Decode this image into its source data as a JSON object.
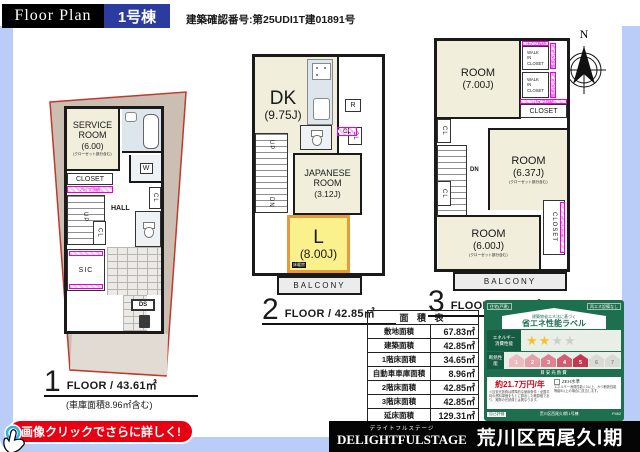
{
  "header": {
    "title": "Floor Plan",
    "unit": "1号棟",
    "permit": "建築確認番号:第25UDI1T建01891号"
  },
  "compass": {
    "north": "N"
  },
  "floor1": {
    "service_room": {
      "name": "SERVICE\nROOM",
      "size": "(6.00)",
      "note": "(クローゼット部分含む)"
    },
    "closet": "CLOSET",
    "pipe": "パイプ収納",
    "w": "W",
    "hall": "HALL",
    "up": "UP",
    "cl": "CL",
    "sic": "SIC",
    "ds": "DS",
    "label": {
      "num": "1",
      "text": "FLOOR / 43.61㎡",
      "sub": "(車庫面積8.96㎡含む)"
    }
  },
  "floor2": {
    "dk": {
      "name": "DK",
      "size": "(9.75J)"
    },
    "r": "R",
    "cl": "CL",
    "up": "UP",
    "dn": "DN",
    "japanese_room": {
      "name": "JAPANESE\nROOM",
      "size": "(3.12J)"
    },
    "living": {
      "name": "L",
      "size": "(8.00J)",
      "heating": "床暖房"
    },
    "balcony": "BALCONY",
    "label": {
      "num": "2",
      "text": "FLOOR / 42.85㎡"
    }
  },
  "floor3": {
    "room_top": {
      "name": "ROOM",
      "size": "(7.00J)"
    },
    "wic": "WALK\nIN\nCLOSET",
    "pipe": "パイプ収納",
    "closet": "CLOSET",
    "cl": "CL",
    "dn": "DN",
    "room_mid": {
      "name": "ROOM",
      "size": "(6.37J)",
      "note": "(クローゼット部分含む)"
    },
    "room_bottom": {
      "name": "ROOM",
      "size": "(6.00J)",
      "note": "(クローゼット部分含む)"
    },
    "balcony": "BALCONY",
    "label": {
      "num": "3",
      "text": "FLOOR / 42.85㎡"
    }
  },
  "area_table": {
    "title": "面 積 表",
    "rows": [
      {
        "label": "敷地面積",
        "value": "67.83㎡"
      },
      {
        "label": "建築面積",
        "value": "42.85㎡"
      },
      {
        "label": "1階床面積",
        "value": "34.65㎡"
      },
      {
        "label": "自動車車庫面積",
        "value": "8.96㎡"
      },
      {
        "label": "2階床面積",
        "value": "42.85㎡"
      },
      {
        "label": "3階床面積",
        "value": "42.85㎡"
      },
      {
        "label": "延床面積",
        "value": "129.31㎡"
      },
      {
        "label": "容積対象面積",
        "value": "120.35㎡"
      }
    ]
  },
  "energy_label": {
    "tag_left": "住宅(戸建)",
    "tag_right": "再エネ設備なし",
    "header_small": "建築物省エネ法に基づく",
    "header_main": "省エネ性能ラベル",
    "row_energy": "エネルギー\n消費性能",
    "row_insulation": "断熱性能",
    "stars_total": 4,
    "stars_filled": 2,
    "insulation_levels": 7,
    "insulation_achieved": 5,
    "cost_heading": "目安光熱費",
    "cost_value": "約21.7万円/年",
    "zeh": "ZEH水準",
    "note_left": "※目安光熱費は標準的な使用条件・全国平均の燃料単価をもとに算出した概算値であり、実際の光熱費とは異なります。",
    "note_right": "エネルギー消費性能☆3以上、かつ断熱性能等級5以上の場合に該当します。",
    "footer_left": "自己評価",
    "footer_mid": "荒川区西尾久Ⅰ期 1号棟",
    "footer_right": "P462"
  },
  "cta": {
    "text": "画像クリックでさらに詳しく!"
  },
  "footer_banner": {
    "ruby": "デライトフルステージ",
    "brand": "DELIGHTFULSTAGE",
    "title": "荒川区西尾久Ⅰ期"
  }
}
